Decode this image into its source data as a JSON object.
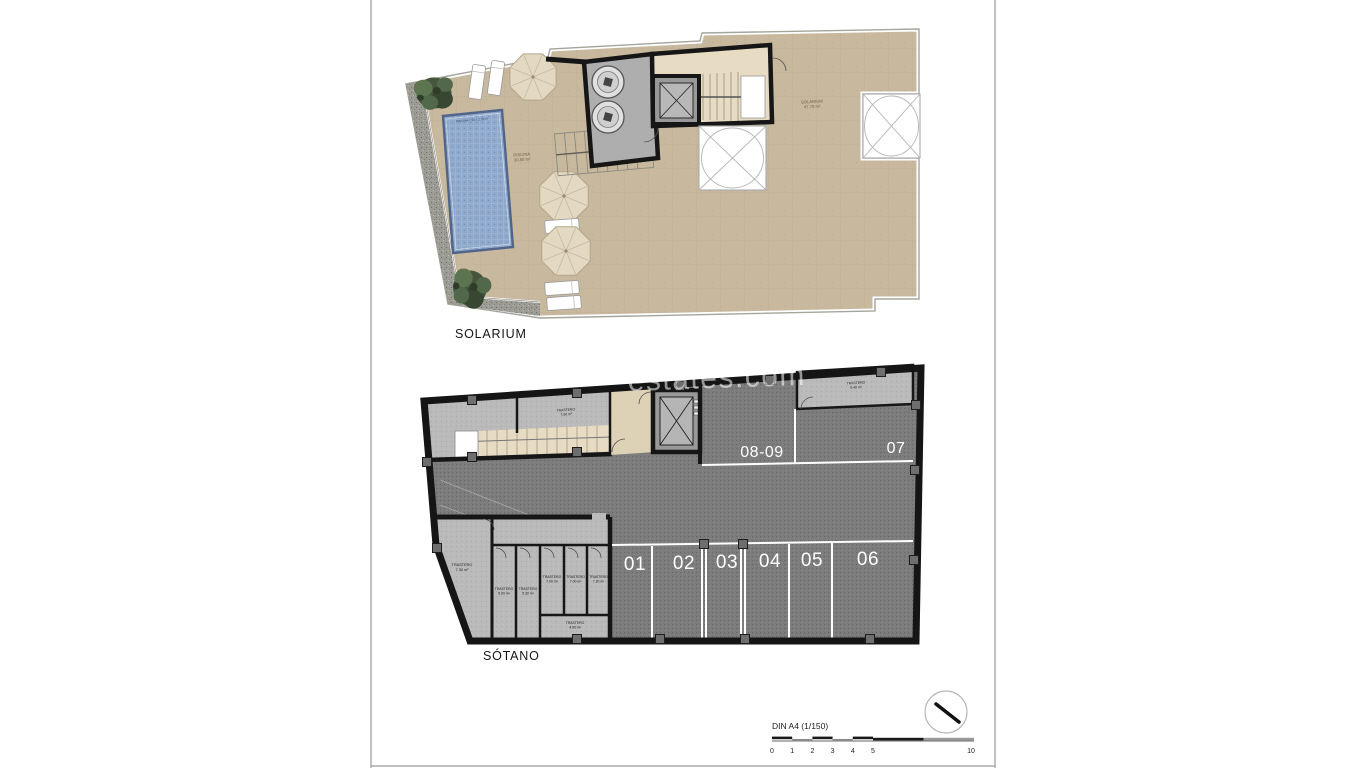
{
  "colors": {
    "terrace": "#c8b89d",
    "pool": "#8fa9cc",
    "parking": "#7c7c7c",
    "storage": "#bababa",
    "stair": "#e7dbc3",
    "lobby": "#ddd1b6",
    "gravel": "#9c9c94",
    "machine_room": "#aeaeae",
    "wall": "#161616"
  },
  "solarium": {
    "title": "SOLARIUM",
    "pool_label": "PISCINA 7.50 x 2.50 m",
    "pool_area": [
      "PISCINA",
      "30.50 m²"
    ],
    "terrace_area": [
      "SOLARIUM",
      "47.70 m²"
    ]
  },
  "sotano": {
    "title": "SÓTANO",
    "parking_top": [
      "08-09",
      "07"
    ],
    "parking_bottom": [
      "01",
      "02",
      "03",
      "04",
      "05",
      "06"
    ],
    "storerooms": [
      {
        "label": "TRASTERO",
        "area": "7.00 m²"
      },
      {
        "label": "TRASTERO",
        "area": "5.40 m²"
      },
      {
        "label": "TRASTERO",
        "area": "7.30 m²"
      },
      {
        "label": "TRASTERO",
        "area": "5.00 m²"
      },
      {
        "label": "TRASTERO",
        "area": "5.30 m²"
      },
      {
        "label": "TRASTERO",
        "area": "7.00 m²"
      },
      {
        "label": "TRASTERO",
        "area": "7.00 m²"
      },
      {
        "label": "TRASTERO",
        "area": "7.20 m²"
      },
      {
        "label": "TRASTERO",
        "area": "4.90 m²"
      }
    ]
  },
  "watermark": {
    "text": "estates.com"
  },
  "scalebar": {
    "label": "DIN A4 (1/150)",
    "ticks": [
      "0",
      "1",
      "2",
      "3",
      "4",
      "5",
      "10"
    ]
  }
}
